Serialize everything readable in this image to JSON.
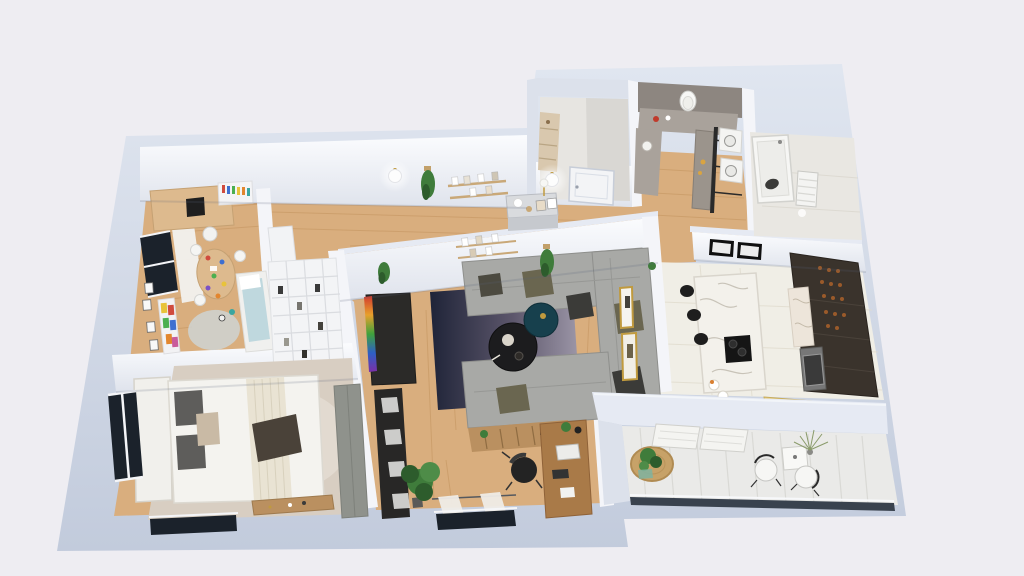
{
  "scene": "3d-apartment-floor-plan-render",
  "canvas": {
    "width": 1024,
    "height": 576
  },
  "palette": {
    "background": "#EEEDF2",
    "wall_outer": "#C8D0E0",
    "wall_top": "#E6EAF3",
    "wall_face": "#F4F5F9",
    "wall_face_shade": "#DCE1EB",
    "taupe_wall": "#8D8680",
    "taupe_counter": "#A9A29B",
    "floor_wood": "#D9AE7E",
    "floor_wood_line": "#C3945F",
    "floor_tile": "#F0EEE6",
    "tile_line": "#E0DBCD",
    "floor_balcony": "#EAEAE8",
    "balcony_plank": "#D9D9D5",
    "floor_bath": "#E9E7E2",
    "closet_floor": "#E7E5E1",
    "rug_kids": "#BFD8DE",
    "rug_bedroom": "#D8CEC2",
    "rug_bedroom_light": "#E7DFD5",
    "sofa": "#A8A9A6",
    "sofa_shade": "#8E8F8C",
    "pillow_olive": "#6A6650",
    "pillow_dark": "#3B3B38",
    "table_black": "#1C1C1E",
    "table_teal": "#17404D",
    "tv_dark": "#2B2A28",
    "shelf_black": "#282726",
    "bed_white": "#F1F0EC",
    "bed_shade": "#DCD9D1",
    "pillow_gray": "#5E5D5B",
    "pillow_beige": "#C9BAA5",
    "throw_dark": "#4A4239",
    "blanket_cream": "#E9E3D3",
    "bench_wood": "#BA9060",
    "desk_wood": "#A97A48",
    "kids_wood": "#DDBA8E",
    "chair_black": "#232323",
    "island_marble": "#F3F1EB",
    "marble_vein": "#C8C3B8",
    "cabinet_dark": "#3A332C",
    "backsplash": "#EDE5DA",
    "bottle_amber": "#9A5A2A",
    "plant_green": "#3F7C3B",
    "plant_dark": "#2D5C2C",
    "door_white": "#F3F4F6",
    "gold": "#C09A3E",
    "jute": "#C7A268",
    "window_dark": "#1B222B",
    "curtain": "#EFECE7",
    "bench_yellow": "#E5CC80",
    "wood_shelf": "#D9C8AE",
    "appliance_white": "#F4F4F2",
    "wardrobe_gray": "#8F928C",
    "red_accent": "#C03A2B"
  }
}
